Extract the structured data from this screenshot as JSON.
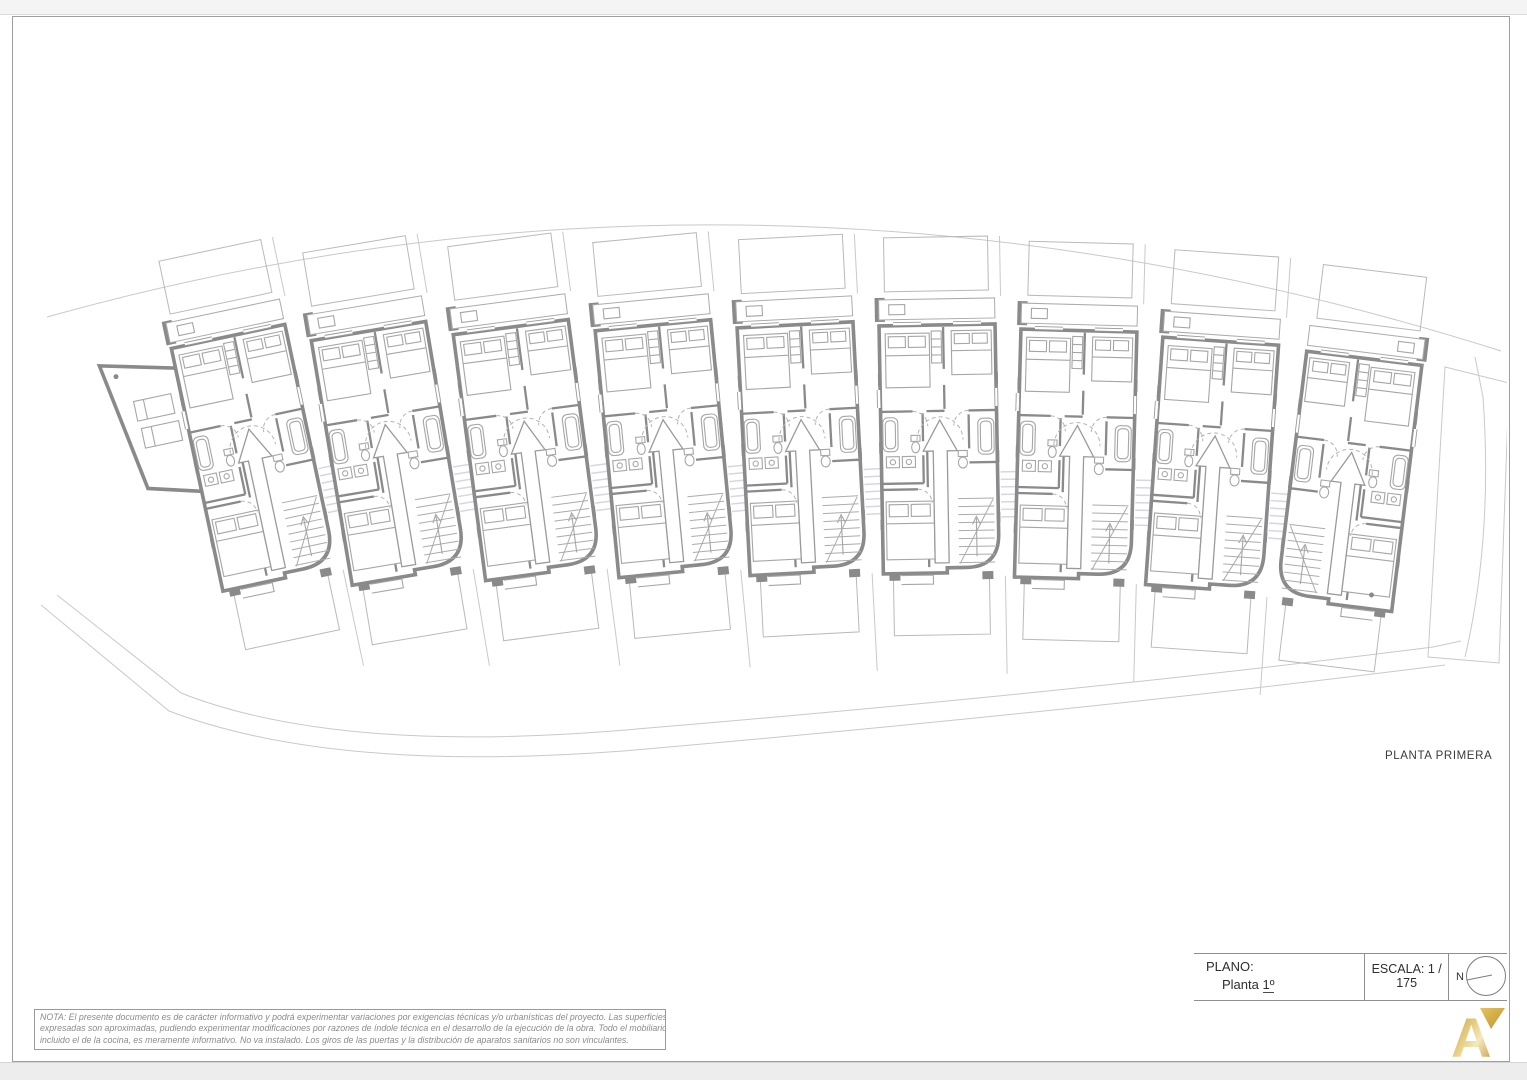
{
  "page": {
    "plan_label": "PLANTA PRIMERA",
    "title_block": {
      "plano_label": "PLANO:",
      "plano_value_prefix": "Planta",
      "plano_value_ordinal": "1º",
      "escala_label": "ESCALA: 1 / 175",
      "north_label": "N"
    },
    "note": {
      "lines": [
        "NOTA: El presente documento es de carácter informativo y podrá experimentar variaciones por exigencias técnicas y/o urbanísticas del proyecto. Las superficies",
        "expresadas son aproximadas, pudiendo experimentar modificaciones por razones de índole técnica en el desarrollo de la ejecución de la obra. Todo el mobiliario",
        "incluido el de la cocina, es meramente informativo. No va instalado. Los giros de las puertas y la distribución de aparatos sanitarios no son vinculantes."
      ]
    },
    "drawing": {
      "units_count": 9
    },
    "colors": {
      "wall": "#8a8a8a",
      "furniture": "#a6a6a6",
      "faint": "#c9c9c9",
      "hatch": "#d8d5e4",
      "gold_dark": "#bf9232",
      "gold_light": "#f4e8bd"
    }
  }
}
